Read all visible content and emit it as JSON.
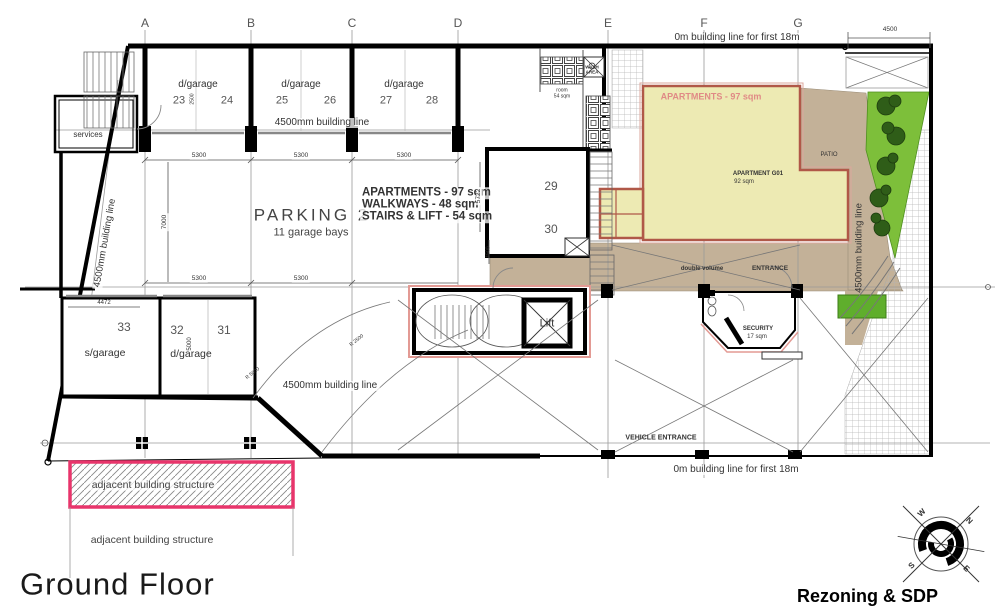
{
  "plan": {
    "floor_title": "Ground Floor",
    "doc_title": "Rezoning & SDP"
  },
  "grid": {
    "letters": [
      "A",
      "B",
      "C",
      "D",
      "E",
      "F",
      "G"
    ]
  },
  "building_lines": {
    "top": "0m building line for first 18m",
    "bottom": "0m building line for first 18m",
    "garage_row": "4500mm building line",
    "left": "4500mm building line",
    "right": "4500mm building line",
    "south": "4500mm building line"
  },
  "garages_top": {
    "bay1": {
      "type": "d/garage",
      "a": "23",
      "b": "24"
    },
    "bay2": {
      "type": "d/garage",
      "a": "25",
      "b": "26"
    },
    "bay3": {
      "type": "d/garage",
      "a": "27",
      "b": "28"
    }
  },
  "garages_south": {
    "g33": "33",
    "g32": "32",
    "g31": "31",
    "s_type": "s/garage",
    "d_type": "d/garage"
  },
  "parking": {
    "name": "PARKING 2",
    "bays": "11 garage bays"
  },
  "schedule": {
    "l1": "APARTMENTS - 97 sqm",
    "l2": "WALKWAYS - 48 sqm",
    "l3": "STAIRS & LIFT - 54 sqm"
  },
  "apartment": {
    "zone": "APARTMENTS - 97 sqm",
    "unit": "APARTMENT G01",
    "unit_area": "92 sqm",
    "patio": "PATIO"
  },
  "rooms": {
    "services": "services",
    "r29": "29",
    "r30": "30",
    "lift": "Lift",
    "wash": "WASH AREA",
    "store": "room",
    "store_area": "54 sqm",
    "security": "SECURITY",
    "security_area": "17 sqm",
    "double_volume": "double volume",
    "entrance": "ENTRANCE",
    "vehicle_entrance": "VEHICLE ENTRANCE"
  },
  "adjacent": {
    "in_hatch": "adjacent building structure",
    "below": "adjacent building structure"
  },
  "dims": {
    "bay": "5300",
    "depth": "7000",
    "right": "5722",
    "top_right": "4500",
    "g33": "4472",
    "g32": "5000",
    "small": "2500",
    "stair": "1500",
    "rad1": "R 5000",
    "rad2": "R 2500"
  },
  "compass": {
    "n": "N",
    "e": "E",
    "s": "S",
    "w": "W"
  },
  "colors": {
    "apartment_fill": "#edeab3",
    "apartment_border": "#b05848",
    "walkway": "#c3b198",
    "lawn": "#7dbf3a",
    "planter": "#5fae2c",
    "tree": "#2f5d18",
    "boundary_pink": "#e8356b",
    "wall": "#000000"
  }
}
